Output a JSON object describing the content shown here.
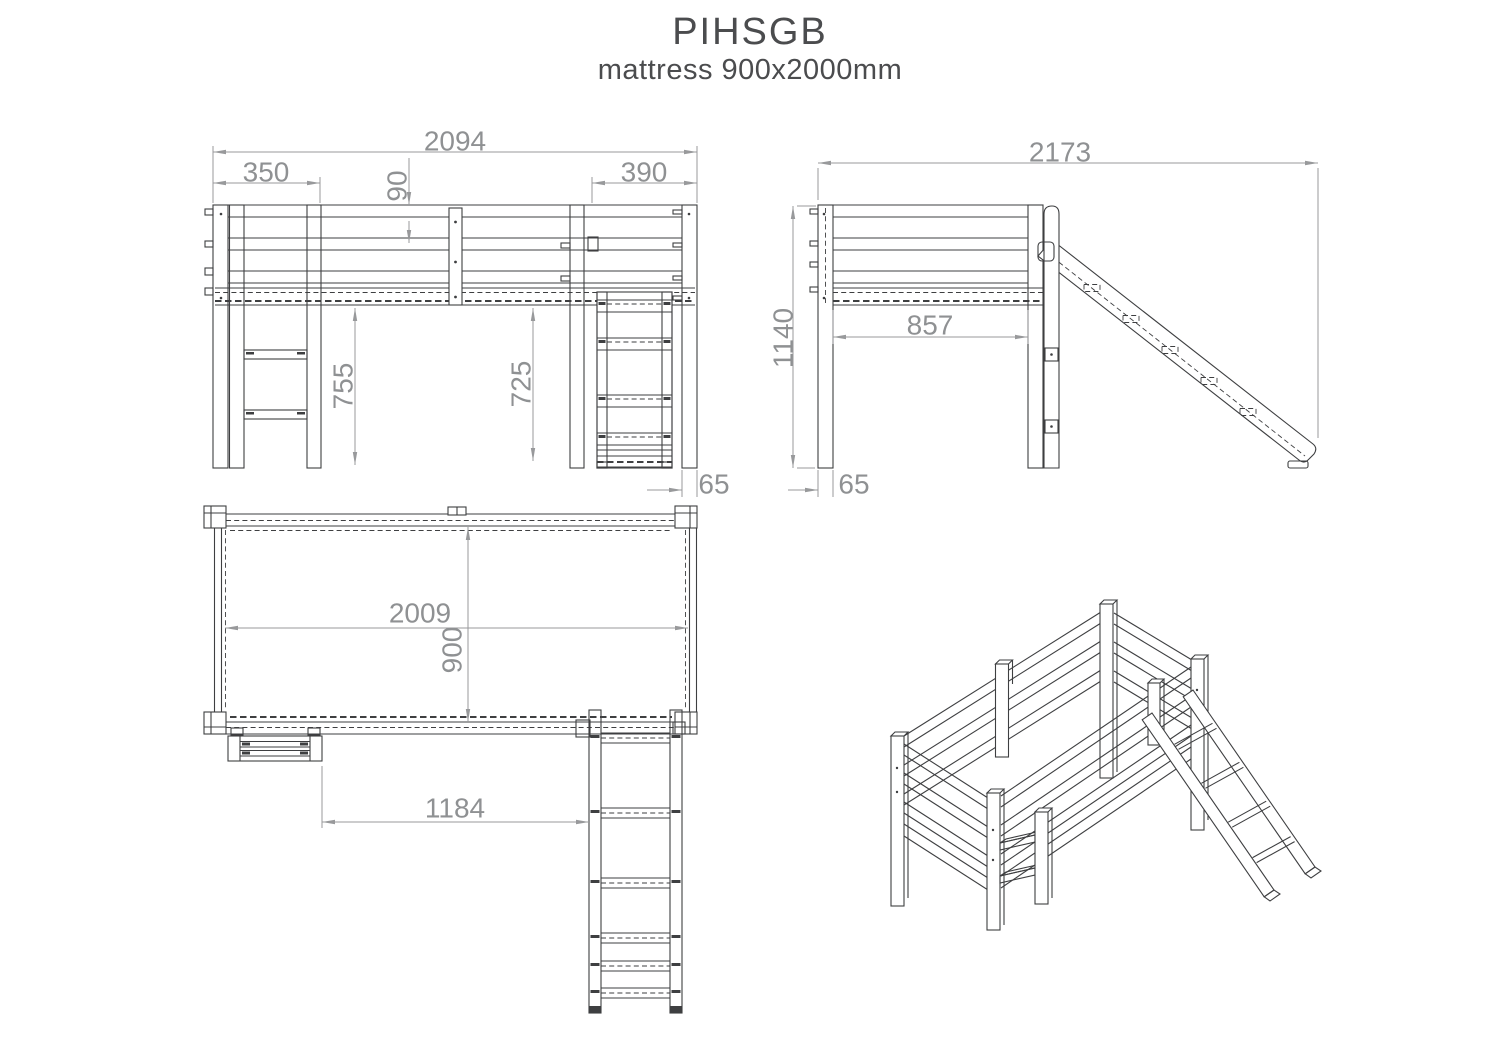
{
  "title": "PIHSGB",
  "subtitle": "mattress 900x2000mm",
  "front": {
    "overall_width": "2094",
    "ladder_section": "350",
    "rail_gap": "90",
    "slide_section": "390",
    "under_bed_height": "755",
    "slide_clear_height": "725",
    "post_offset": "65"
  },
  "side": {
    "overall_depth": "2173",
    "overall_height": "1140",
    "inner_depth": "857",
    "post_width": "65"
  },
  "plan": {
    "inner_length": "2009",
    "inner_width": "900",
    "ladder_to_slide": "1184"
  },
  "colors": {
    "line": "#3e3f41",
    "dimension": "#98999b",
    "dim_text": "#8f9193",
    "title_text": "#4b4c4e",
    "background": "#ffffff"
  }
}
